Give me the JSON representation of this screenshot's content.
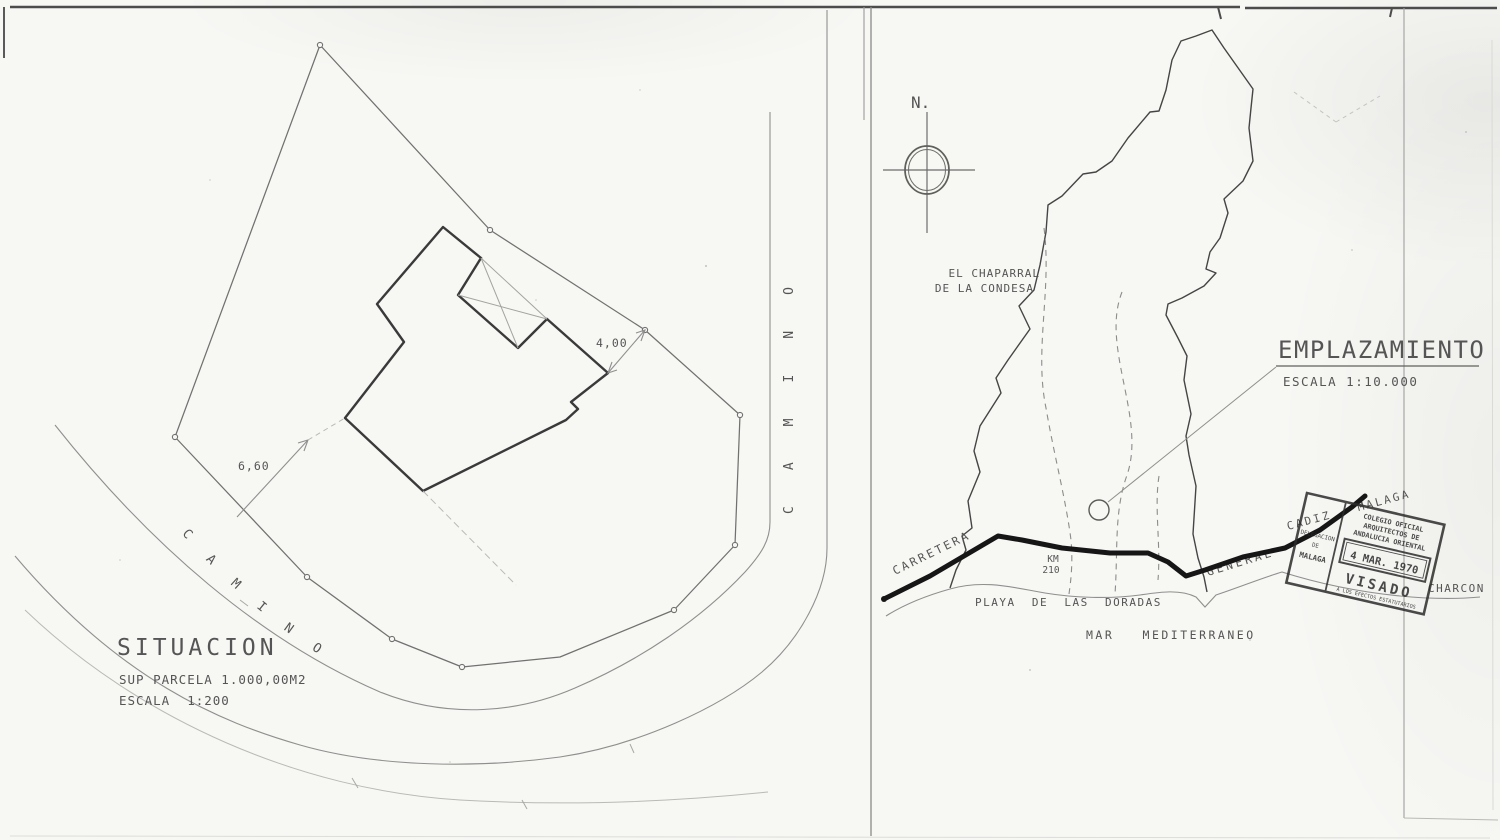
{
  "situacion": {
    "title": "SITUACION",
    "parcel_area_label": "SUP PARCELA 1.000,00M2",
    "scale_label": "ESCALA  1:200",
    "dim_top": "4,00",
    "dim_left": "6,60",
    "road_label_diagonal": "CAMINO",
    "road_label_vertical": "CAMINO"
  },
  "emplazamiento": {
    "title": "EMPLAZAMIENTO",
    "scale_label": "ESCALA 1:10.000",
    "north_label": "N.",
    "area_label_line1": "EL CHAPARRAL",
    "area_label_line2": "DE LA CONDESA",
    "road_label_1": "CARRETERA",
    "road_label_2": "GENERAL",
    "road_label_3": "CADIZ - MALAGA",
    "km_label": "KM",
    "km_value": "210",
    "beach_label": "PLAYA  DE  LAS  DORADAS",
    "sea_label": "MAR   MEDITERRANEO",
    "place_label_right": "CHARCON"
  },
  "stamp": {
    "college_line1": "COLEGIO OFICIAL",
    "college_line2": "ARQUITECTOS DE",
    "college_line3": "ANDALUCIA ORIENTAL",
    "delegation_line1": "DELEGACION",
    "delegation_line2": "DE",
    "delegation_line3": "MALAGA",
    "date": "4 MAR. 1970",
    "visa": "VISADO",
    "footer": "A LOS EFECTOS ESTATUTARIOS"
  },
  "colors": {
    "paper": "#f7f7f4",
    "ink": "#3a3a3a",
    "light_ink": "#8f8f8f",
    "road_ink": "#161616",
    "stamp_ink": "#2c2c2c"
  }
}
